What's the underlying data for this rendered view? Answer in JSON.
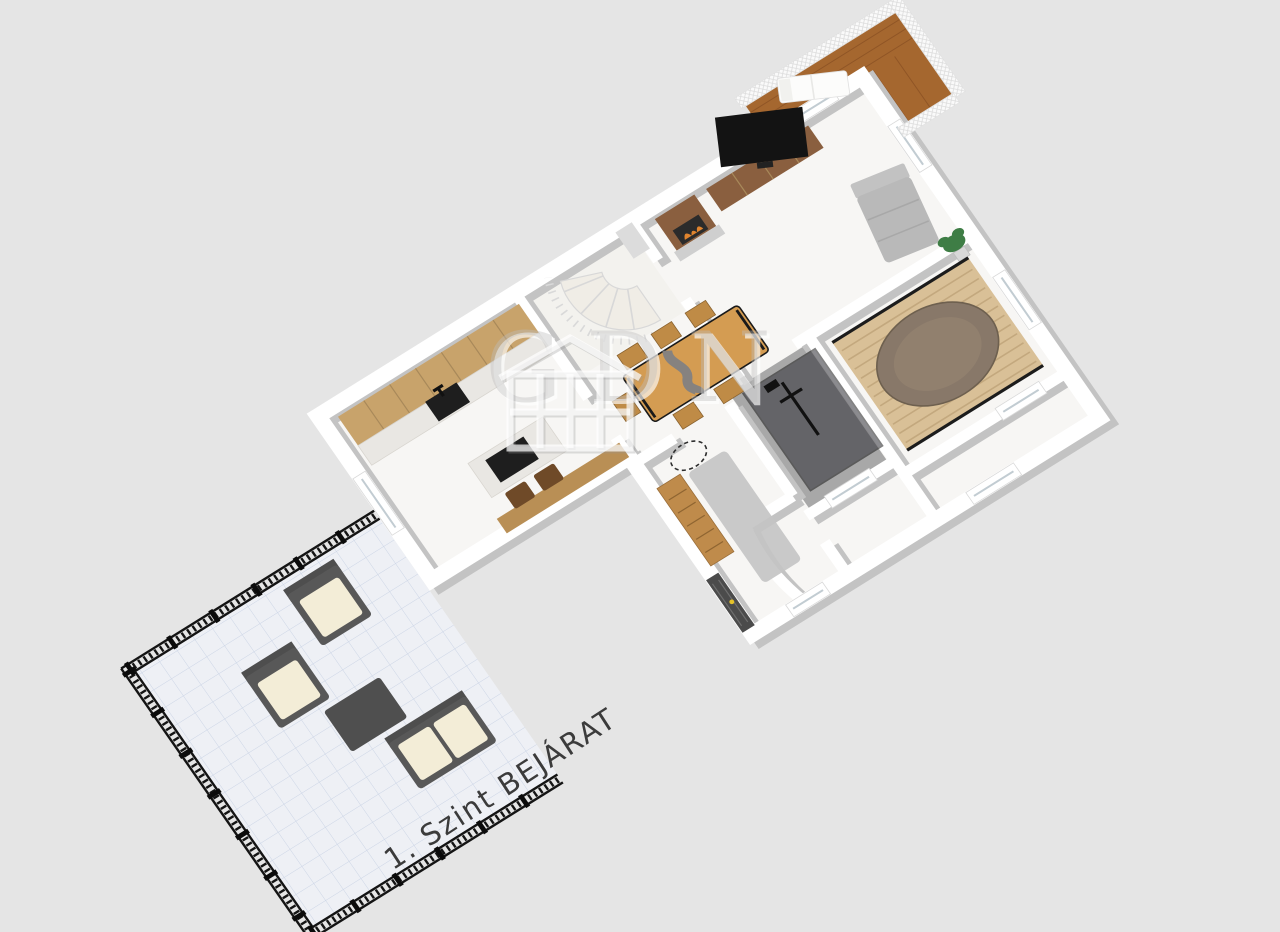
{
  "scene": {
    "description": "3D isometric floor plan render of first floor with terrace and balcony",
    "objects": [
      "terrace",
      "ornamental-fence",
      "outdoor-armchairs",
      "outdoor-sofa",
      "outdoor-coffee-table",
      "kitchen-cabinets",
      "kitchen-island",
      "bar-stools",
      "spiral-staircase",
      "dining-table",
      "dining-chairs",
      "tv",
      "tv-console",
      "fireplace",
      "chaise-sofa",
      "potted-plant",
      "oval-bed",
      "bed-platform",
      "shower-enclosure",
      "dresser",
      "wall-mirror",
      "runner-rug",
      "front-door",
      "balcony",
      "sun-lounger",
      "windows"
    ]
  },
  "caption": {
    "text": "1. Szint BEJÁRAT",
    "rotation_deg": -33
  },
  "watermark": {
    "text": "GDN",
    "icon": "house-outline-icon"
  },
  "colors": {
    "background": "#e5e5e5",
    "wall": "#ffffff",
    "wall-shadow": "#c3c3c3",
    "floor": "#f7f6f4",
    "floor-stair": "#f3f2ee",
    "bath-floor": "#a8a8a8",
    "cabinet-wood": "#c8a36b",
    "cabinet-line": "#a8895a",
    "marble": "#e9e7e3",
    "sink": "#1e1e1e",
    "island-wood": "#b98f55",
    "stool": "#6f4a28",
    "stair": "#f0ede6",
    "stair-line": "#d8d8d8",
    "table-wood": "#d49c52",
    "river": "#7d8084",
    "chair-wood": "#bf8b46",
    "console-wood": "#8a5f3f",
    "hearth": "#cfcfcf",
    "fire": "#e0842e",
    "sofa-gray": "#b9b9b9",
    "platform": "#d9c097",
    "platform-stripe": "#c3a87e",
    "platform-edge": "#1c1c1c",
    "oval": "#887869",
    "glass": "#2e2e34",
    "fixture": "#111111",
    "dresser-wood": "#bf8b4b",
    "rug": "#c4c4c4",
    "mirror": "#2e2e2e",
    "door": "#4b4b4b",
    "handle": "#e6c32a",
    "balcony-wood": "#a5672f",
    "plank-line": "#8f5526",
    "railing": "#fafafa",
    "terrace-tile": "#eef0f5",
    "tile-line": "#ccd5e6",
    "fence": "#141414",
    "outdoor-frame": "#585858",
    "outdoor-cushion": "#f3edd7",
    "outdoor-table": "#4f4f4f",
    "tv": "#131313",
    "plant": "#3e7d45",
    "pot": "#d8d8d8",
    "window-frame": "#ffffff",
    "window-line": "#c2ccd2",
    "caption": "#3b3b3b",
    "watermark-fill": "rgba(190,190,190,0.40)",
    "watermark-emboss": "rgba(255,255,255,0.65)"
  }
}
